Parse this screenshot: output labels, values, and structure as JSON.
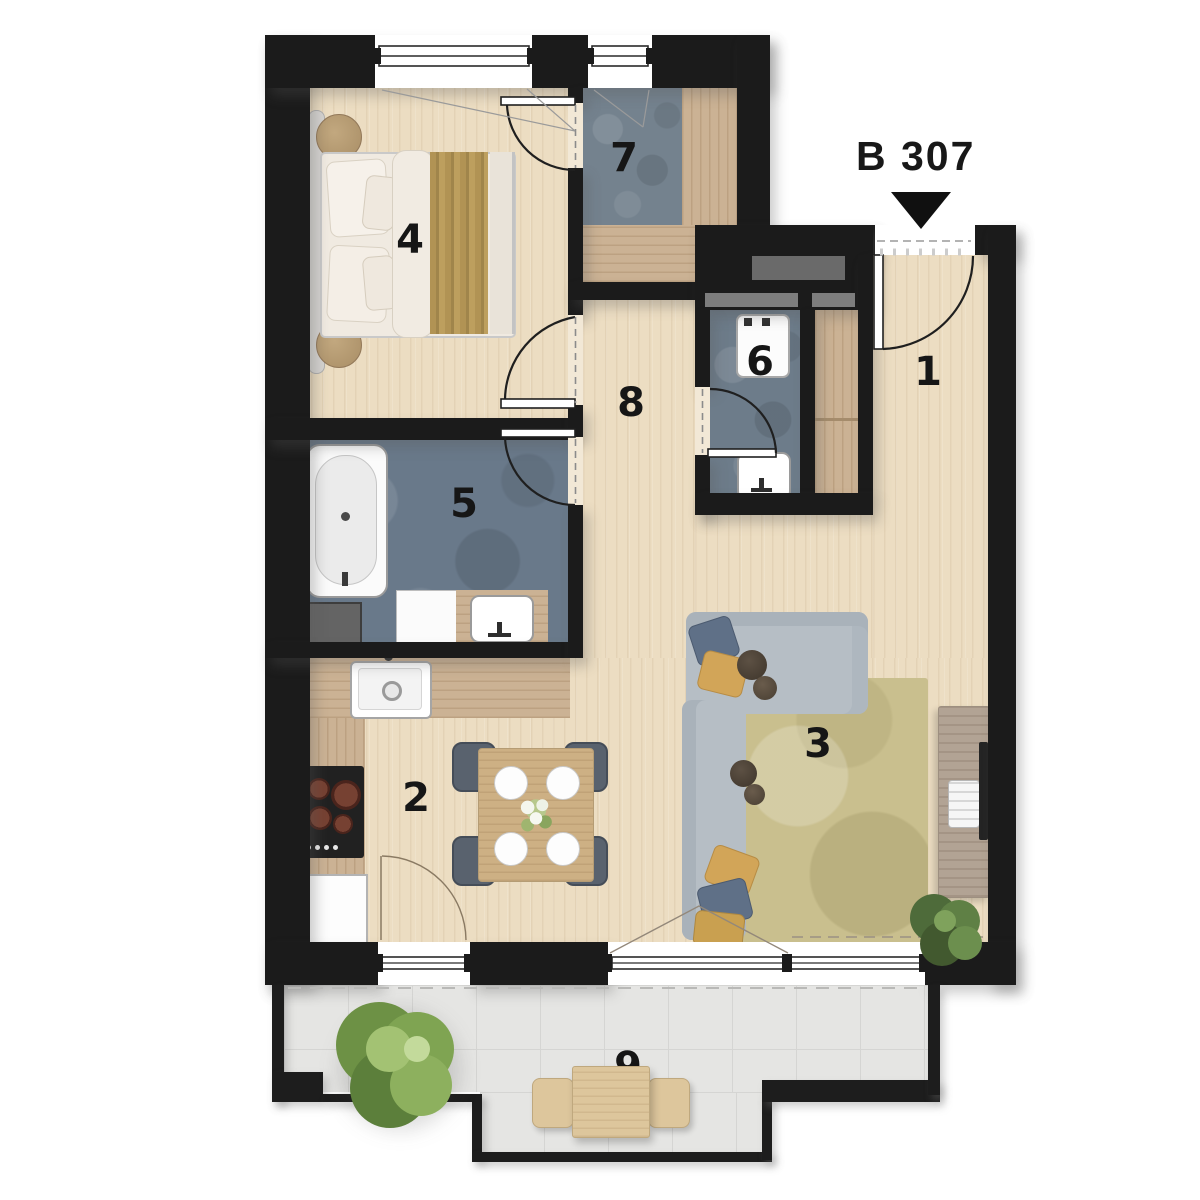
{
  "unit": {
    "label": "B 307"
  },
  "rooms": [
    {
      "number": "1"
    },
    {
      "number": "2"
    },
    {
      "number": "3"
    },
    {
      "number": "4"
    },
    {
      "number": "5"
    },
    {
      "number": "6"
    },
    {
      "number": "7"
    },
    {
      "number": "8"
    },
    {
      "number": "9"
    }
  ],
  "colors": {
    "wall": "#1b1b1b",
    "wood_floor": "#ecddc2",
    "counter_wood": "#cbb294",
    "wet_room_floor": "#71808e",
    "terrace_tile": "#e5e5e3",
    "rug": "#c9bf8e",
    "sofa": "#b6bec5",
    "blanket": "#b09352",
    "label_text": "#161616"
  }
}
